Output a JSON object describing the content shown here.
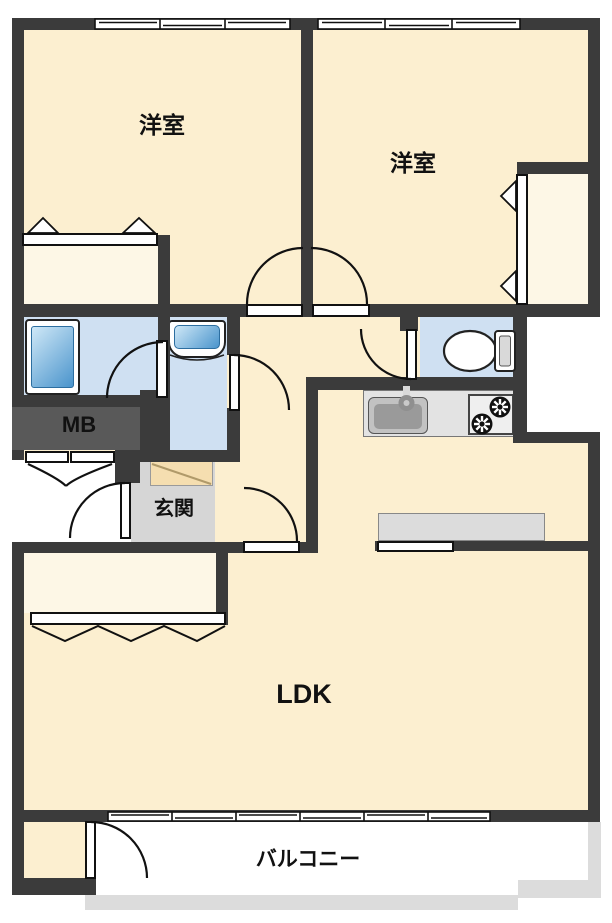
{
  "labels": {
    "room1": "洋室",
    "room2": "洋室",
    "meter_box": "MB",
    "entrance": "玄関",
    "ldk": "LDK",
    "balcony": "バルコニー"
  },
  "colors": {
    "wall": "#3b3b3b",
    "room_floor": "#fcefd0",
    "closet_floor": "#fdf7e6",
    "wet_area_floor": "#cfe0f2",
    "entrance_floor": "#d6d6d6",
    "meter_box_bg": "#595959",
    "counter": "#e3e3e3",
    "bar_counter": "#dcdcdc",
    "balcony_rail": "#dcdcdc",
    "fixture_blue_light": "#cfe8f7",
    "fixture_blue_dark": "#4a94cc",
    "shoe_cabinet": "#f5deb0"
  },
  "fixtures": {
    "bathtub": "bathtub-icon",
    "washbasin": "washbasin-icon",
    "toilet": "toilet-icon",
    "kitchen_sink": "kitchen-sink-icon",
    "stove": "stove-burners-icon",
    "shoe_cabinet": "shoe-cabinet-icon"
  }
}
